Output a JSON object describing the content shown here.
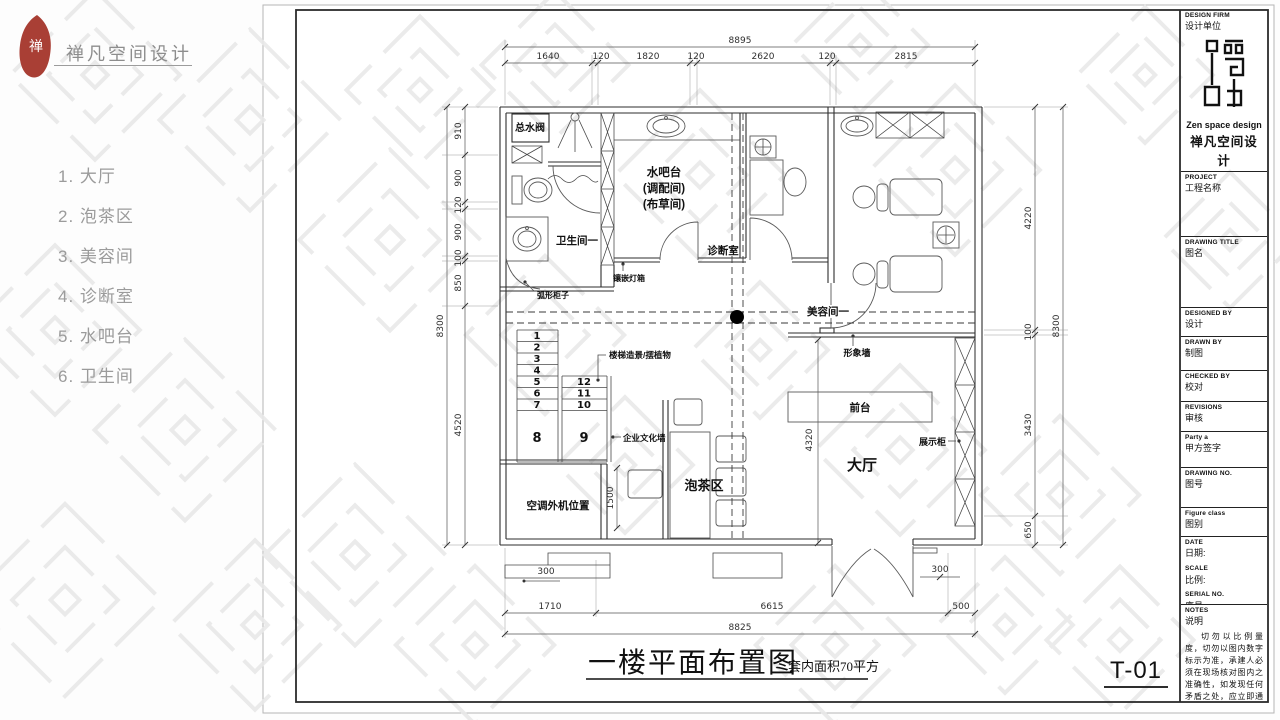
{
  "brand": {
    "logo_char": "禅",
    "name_cn": "禅凡空间设计",
    "name_en": "Zen space design"
  },
  "sidebar": {
    "items": [
      "1. 大厅",
      "2. 泡茶区",
      "3. 美容间",
      "4. 诊断室",
      "5. 水吧台",
      "6. 卫生间"
    ]
  },
  "drawing": {
    "title": "一楼平面布置图",
    "area_note": "套内面积70平方",
    "sheet_no": "T-01",
    "rooms": {
      "main_valve": "总水阀",
      "water_bar_1": "水吧台",
      "water_bar_2": "(调配间)",
      "water_bar_3": "(布草间)",
      "bathroom": "卫生间一",
      "diagnosis": "诊断室",
      "beauty": "美容间一",
      "lobby": "大厅",
      "tea": "泡茶区",
      "ac_unit": "空调外机位置",
      "front_desk": "前台"
    },
    "labels": {
      "curved_cabinet": "弧形柜子",
      "inlaid_lightbox": "镶嵌灯箱",
      "stair_plants": "楼梯造景/摆植物",
      "culture_wall": "企业文化墙",
      "image_wall": "形象墙",
      "display_cabinet": "展示柜"
    },
    "stairs": [
      "1",
      "2",
      "3",
      "4",
      "5",
      "6",
      "7",
      "8",
      "9",
      "10",
      "11",
      "12"
    ],
    "dims": {
      "top_total": "8895",
      "top": [
        "1640",
        "120",
        "1820",
        "120",
        "2620",
        "120",
        "2815"
      ],
      "left_total": "8300",
      "left": [
        "910",
        "900",
        "120",
        "900",
        "100",
        "850",
        "4520"
      ],
      "right_total": "8300",
      "right": [
        "4220",
        "100",
        "3430",
        "650"
      ],
      "bottom": [
        "1710",
        "6615",
        "500"
      ],
      "bottom_total": "8825",
      "step_left": "300",
      "step_right": "300",
      "ac_depth": "1500",
      "lobby_width": "4320"
    }
  },
  "titleblock": {
    "design_firm_en": "DESIGN FIRM",
    "design_firm_cn": "设计单位",
    "logo_en": "Zen space design",
    "logo_cn": "禅凡空间设计",
    "project_en": "PROJECT",
    "project_cn": "工程名称",
    "drawing_title_en": "DRAWING TITLE",
    "drawing_title_cn": "图名",
    "designed_by_en": "DESIGNED BY",
    "designed_by_cn": "设计",
    "drawn_by_en": "DRAWN BY",
    "drawn_by_cn": "制图",
    "checked_by_en": "CHECKED BY",
    "checked_by_cn": "校对",
    "revisions_en": "REVISIONS",
    "revisions_cn": "审核",
    "party_a_en": "Party a",
    "party_a_cn": "甲方签字",
    "drawing_no_en": "DRAWING NO.",
    "drawing_no_cn": "图号",
    "figure_class_en": "Figure class",
    "figure_class_cn": "图别",
    "date_en": "DATE",
    "date_cn": "日期:",
    "scale_en": "SCALE",
    "scale_cn": "比例:",
    "serial_en": "SERIAL NO.",
    "serial_cn": "序号:",
    "notes_en": "NOTES",
    "notes_cn": "说明",
    "notes_text": "切勿以比例量度，切勿以图内数字标示为准，承建人必须在现场核对图内之准确性，如发现任何矛盾之处，应立即通知设计师。"
  },
  "colors": {
    "logo_red": "#a93f35",
    "line": "#2e2e2e",
    "text_gray": "#9b9b9b"
  }
}
